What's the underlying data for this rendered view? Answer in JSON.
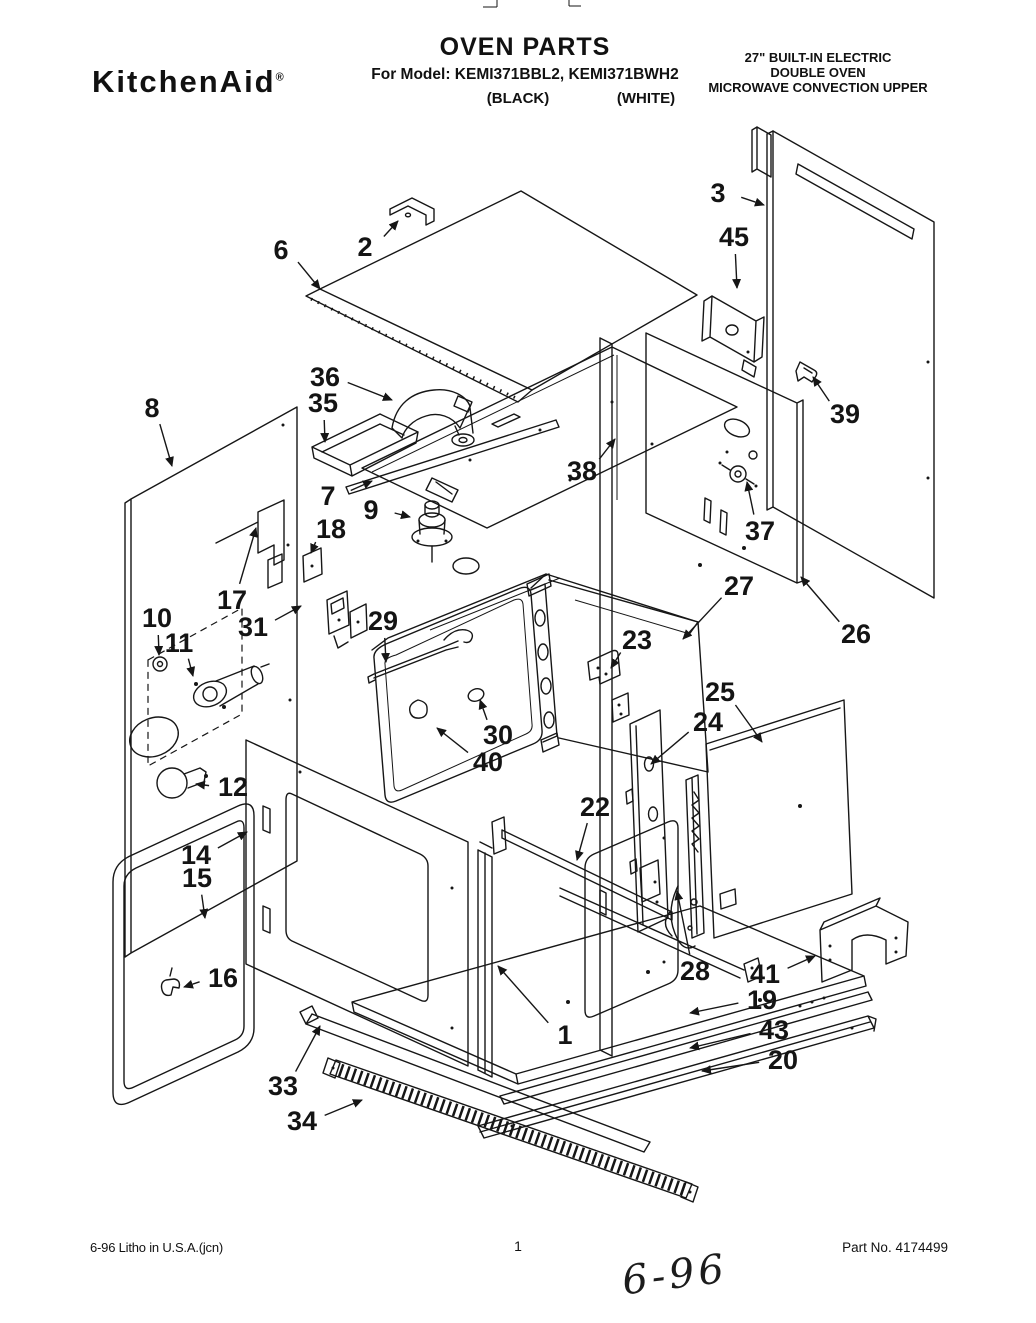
{
  "header": {
    "brand": "KitchenAid",
    "registered_mark": "®",
    "title": "OVEN PARTS",
    "model_line": "For Model: KEMI371BBL2, KEMI371BWH2",
    "finish_left": "(BLACK)",
    "finish_right": "(WHITE)",
    "spec_lines": [
      "27\" BUILT-IN ELECTRIC",
      "DOUBLE OVEN",
      "MICROWAVE CONVECTION UPPER"
    ]
  },
  "footer": {
    "litho": "6-96 Litho in U.S.A.(jcn)",
    "page_number": "1",
    "part_no": "Part No. 4174499",
    "handwritten_note": "6-96"
  },
  "diagram": {
    "ink_color": "#161616",
    "callouts": [
      {
        "num": "1",
        "lx": 565,
        "ly": 1035,
        "ax": 498,
        "ay": 966
      },
      {
        "num": "2",
        "lx": 365,
        "ly": 247,
        "ax": 398,
        "ay": 221
      },
      {
        "num": "3",
        "lx": 718,
        "ly": 193,
        "ax": 764,
        "ay": 205
      },
      {
        "num": "6",
        "lx": 281,
        "ly": 250,
        "ax": 320,
        "ay": 289
      },
      {
        "num": "7",
        "lx": 328,
        "ly": 496,
        "ax": 372,
        "ay": 481
      },
      {
        "num": "8",
        "lx": 152,
        "ly": 408,
        "ax": 172,
        "ay": 466
      },
      {
        "num": "9",
        "lx": 371,
        "ly": 510,
        "ax": 410,
        "ay": 517
      },
      {
        "num": "10",
        "lx": 157,
        "ly": 618,
        "ax": 159,
        "ay": 655
      },
      {
        "num": "11",
        "lx": 179,
        "ly": 643,
        "ax": 193,
        "ay": 676
      },
      {
        "num": "12",
        "lx": 233,
        "ly": 787,
        "ax": 196,
        "ay": 784
      },
      {
        "num": "14",
        "lx": 196,
        "ly": 855,
        "ax": 247,
        "ay": 832
      },
      {
        "num": "15",
        "lx": 197,
        "ly": 878,
        "ax": 205,
        "ay": 918
      },
      {
        "num": "16",
        "lx": 223,
        "ly": 978,
        "ax": 184,
        "ay": 987
      },
      {
        "num": "17",
        "lx": 232,
        "ly": 600,
        "ax": 256,
        "ay": 528
      },
      {
        "num": "18",
        "lx": 331,
        "ly": 529,
        "ax": 311,
        "ay": 553
      },
      {
        "num": "19",
        "lx": 762,
        "ly": 1000,
        "ax": 690,
        "ay": 1013
      },
      {
        "num": "20",
        "lx": 783,
        "ly": 1060,
        "ax": 702,
        "ay": 1071
      },
      {
        "num": "22",
        "lx": 595,
        "ly": 807,
        "ax": 577,
        "ay": 860
      },
      {
        "num": "23",
        "lx": 637,
        "ly": 640,
        "ax": 611,
        "ay": 668
      },
      {
        "num": "24",
        "lx": 708,
        "ly": 722,
        "ax": 651,
        "ay": 764
      },
      {
        "num": "25",
        "lx": 720,
        "ly": 692,
        "ax": 762,
        "ay": 742
      },
      {
        "num": "26",
        "lx": 856,
        "ly": 634,
        "ax": 801,
        "ay": 577
      },
      {
        "num": "27",
        "lx": 739,
        "ly": 586,
        "ax": 683,
        "ay": 639
      },
      {
        "num": "28",
        "lx": 695,
        "ly": 971,
        "ax": 677,
        "ay": 891
      },
      {
        "num": "29",
        "lx": 383,
        "ly": 621,
        "ax": 386,
        "ay": 662
      },
      {
        "num": "30",
        "lx": 498,
        "ly": 735,
        "ax": 480,
        "ay": 700
      },
      {
        "num": "31",
        "lx": 253,
        "ly": 627,
        "ax": 301,
        "ay": 606
      },
      {
        "num": "33",
        "lx": 283,
        "ly": 1086,
        "ax": 320,
        "ay": 1026
      },
      {
        "num": "34",
        "lx": 302,
        "ly": 1121,
        "ax": 362,
        "ay": 1100
      },
      {
        "num": "35",
        "lx": 323,
        "ly": 403,
        "ax": 325,
        "ay": 442
      },
      {
        "num": "36",
        "lx": 325,
        "ly": 377,
        "ax": 392,
        "ay": 400
      },
      {
        "num": "37",
        "lx": 760,
        "ly": 531,
        "ax": 747,
        "ay": 482
      },
      {
        "num": "38",
        "lx": 582,
        "ly": 471,
        "ax": 615,
        "ay": 439
      },
      {
        "num": "39",
        "lx": 845,
        "ly": 414,
        "ax": 813,
        "ay": 377
      },
      {
        "num": "40",
        "lx": 488,
        "ly": 762,
        "ax": 437,
        "ay": 728
      },
      {
        "num": "41",
        "lx": 765,
        "ly": 974,
        "ax": 815,
        "ay": 956
      },
      {
        "num": "43",
        "lx": 774,
        "ly": 1030,
        "ax": 690,
        "ay": 1048
      },
      {
        "num": "45",
        "lx": 734,
        "ly": 237,
        "ax": 737,
        "ay": 288
      }
    ]
  }
}
